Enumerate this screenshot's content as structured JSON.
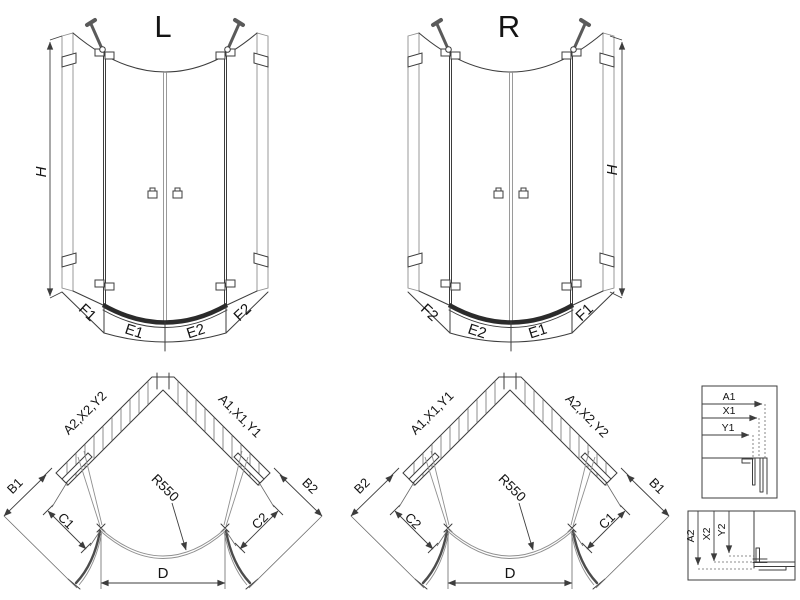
{
  "front_left": {
    "title": "L",
    "height_label": "H",
    "segments": [
      "F1",
      "E1",
      "E2",
      "F2"
    ]
  },
  "front_right": {
    "title": "R",
    "height_label": "H",
    "segments": [
      "F2",
      "E2",
      "E1",
      "F1"
    ]
  },
  "plan_left": {
    "wall_label_left": "A2,X2,Y2",
    "wall_label_right": "A1,X1,Y1",
    "outer_dim_left": "B1",
    "outer_dim_right": "B2",
    "panel_dim_left": "C1",
    "panel_dim_right": "C2",
    "radius_label": "R550",
    "width_label": "D"
  },
  "plan_right": {
    "wall_label_left": "A1,X1,Y1",
    "wall_label_right": "A2,X2,Y2",
    "outer_dim_left": "B2",
    "outer_dim_right": "B1",
    "panel_dim_left": "C2",
    "panel_dim_right": "C1",
    "radius_label": "R550",
    "width_label": "D"
  },
  "detail_top": {
    "dim_labels": [
      "A1",
      "X1",
      "Y1"
    ]
  },
  "detail_bottom": {
    "dim_labels": [
      "A2",
      "X2",
      "Y2"
    ]
  },
  "colors": {
    "background": "#ffffff",
    "line": "#3d3d3d",
    "glass_line": "#8f8f8f",
    "tray_rim": "#2b2b2b"
  }
}
